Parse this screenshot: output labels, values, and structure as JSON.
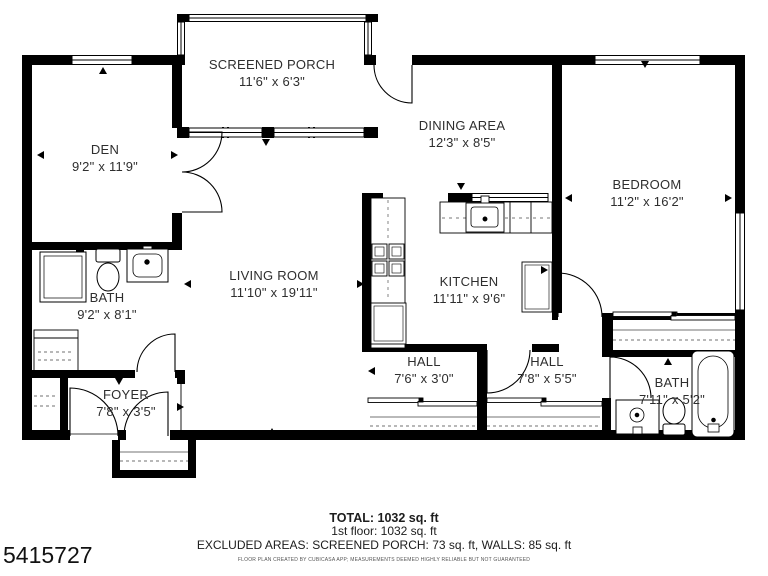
{
  "listing_id": "5415727",
  "plan": {
    "rooms": [
      {
        "id": "screened-porch",
        "name": "SCREENED PORCH",
        "dims": "11'6\" x 6'3\""
      },
      {
        "id": "den",
        "name": "DEN",
        "dims": "9'2\" x 11'9\""
      },
      {
        "id": "dining-area",
        "name": "DINING AREA",
        "dims": "12'3\" x 8'5\""
      },
      {
        "id": "bedroom",
        "name": "BEDROOM",
        "dims": "11'2\" x 16'2\""
      },
      {
        "id": "living-room",
        "name": "LIVING ROOM",
        "dims": "11'10\" x 19'11\""
      },
      {
        "id": "kitchen",
        "name": "KITCHEN",
        "dims": "11'11\" x 9'6\""
      },
      {
        "id": "bath-left",
        "name": "BATH",
        "dims": "9'2\" x 8'1\""
      },
      {
        "id": "foyer",
        "name": "FOYER",
        "dims": "7'8\" x 3'5\""
      },
      {
        "id": "hall-left",
        "name": "HALL",
        "dims": "7'6\" x 3'0\""
      },
      {
        "id": "hall-right",
        "name": "HALL",
        "dims": "7'8\" x 5'5\""
      },
      {
        "id": "bath-right",
        "name": "BATH",
        "dims": "7'11\" x 5'2\""
      }
    ],
    "fixtures": {
      "kitchen": [
        "counter",
        "stove",
        "sink",
        "dishwasher",
        "refrigerator"
      ],
      "bath_left": [
        "shower-cabinet",
        "toilet",
        "sink"
      ],
      "bath_right": [
        "sink",
        "toilet",
        "bathtub"
      ],
      "closets": [
        "bedroom-closet",
        "hall-closets",
        "foyer-closet",
        "bath-closet"
      ]
    }
  },
  "footer": {
    "total": "TOTAL: 1032 sq. ft",
    "floor": "1st floor: 1032 sq. ft",
    "excluded": "EXCLUDED AREAS: SCREENED PORCH: 73 sq. ft, WALLS: 85 sq. ft",
    "disclaimer": "FLOOR PLAN CREATED BY CUBICASA APP; MEASUREMENTS DEEMED HIGHLY RELIABLE BUT NOT GUARANTEED"
  },
  "colors": {
    "wall": "#000000",
    "floor": "#ffffff",
    "text": "#2e2e2e"
  }
}
